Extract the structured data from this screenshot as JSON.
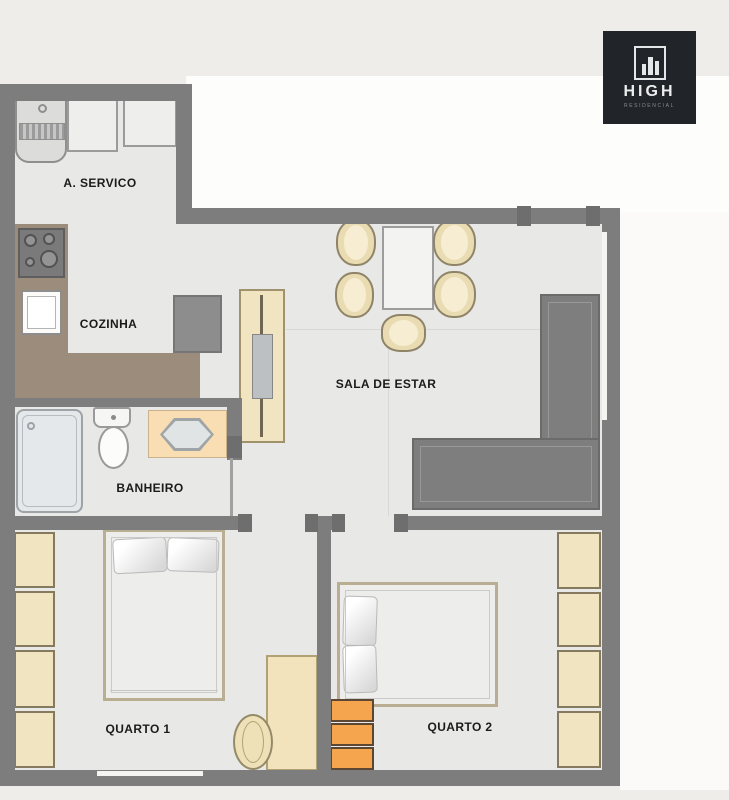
{
  "logo": {
    "brand": "HIGH",
    "subtitle": "RESIDENCIAL",
    "icon": "building-skyline-icon",
    "bg_color": "#212428",
    "fg_color": "#e9ecec"
  },
  "rooms": {
    "service": {
      "label": "A. SERVICO"
    },
    "kitchen": {
      "label": "COZINHA"
    },
    "living": {
      "label": "SALA DE ESTAR"
    },
    "bathroom": {
      "label": "BANHEIRO"
    },
    "bedroom1": {
      "label": "QUARTO 1"
    },
    "bedroom2": {
      "label": "QUARTO 2"
    }
  },
  "colors": {
    "page_bg": "#efedea",
    "outside_white": "#fdfdfc",
    "floor": "#e8e8e7",
    "wall": "#7d7d7d",
    "wall_dark": "#6e6e6e",
    "counter_brown": "#9c8c7b",
    "cream": "#f1e4c1",
    "cream_dark": "#8f8468",
    "orange": "#f4a54e",
    "orange_border": "#5b4733",
    "peach": "#f9ddb3",
    "shower_glass": "#e4e8ea",
    "sofa": "#7e7e7e",
    "label_text": "#1b1b1b",
    "logo_bg": "#212428"
  }
}
